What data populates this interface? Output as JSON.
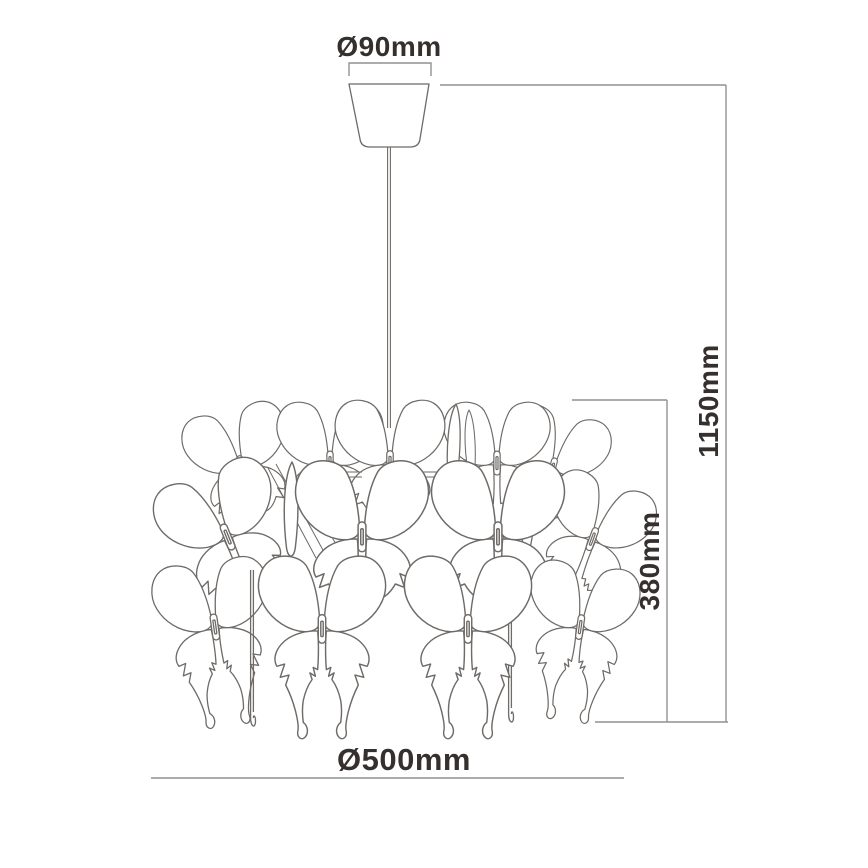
{
  "diagram": {
    "labels": {
      "canopy_diameter": "Ø90mm",
      "total_drop": "1150mm",
      "shade_height": "380mm",
      "shade_diameter": "Ø500mm"
    },
    "colors": {
      "background": "#ffffff",
      "text": "#35302d",
      "dimension_line": "#919191",
      "drawing_line": "#6e6a67"
    }
  }
}
